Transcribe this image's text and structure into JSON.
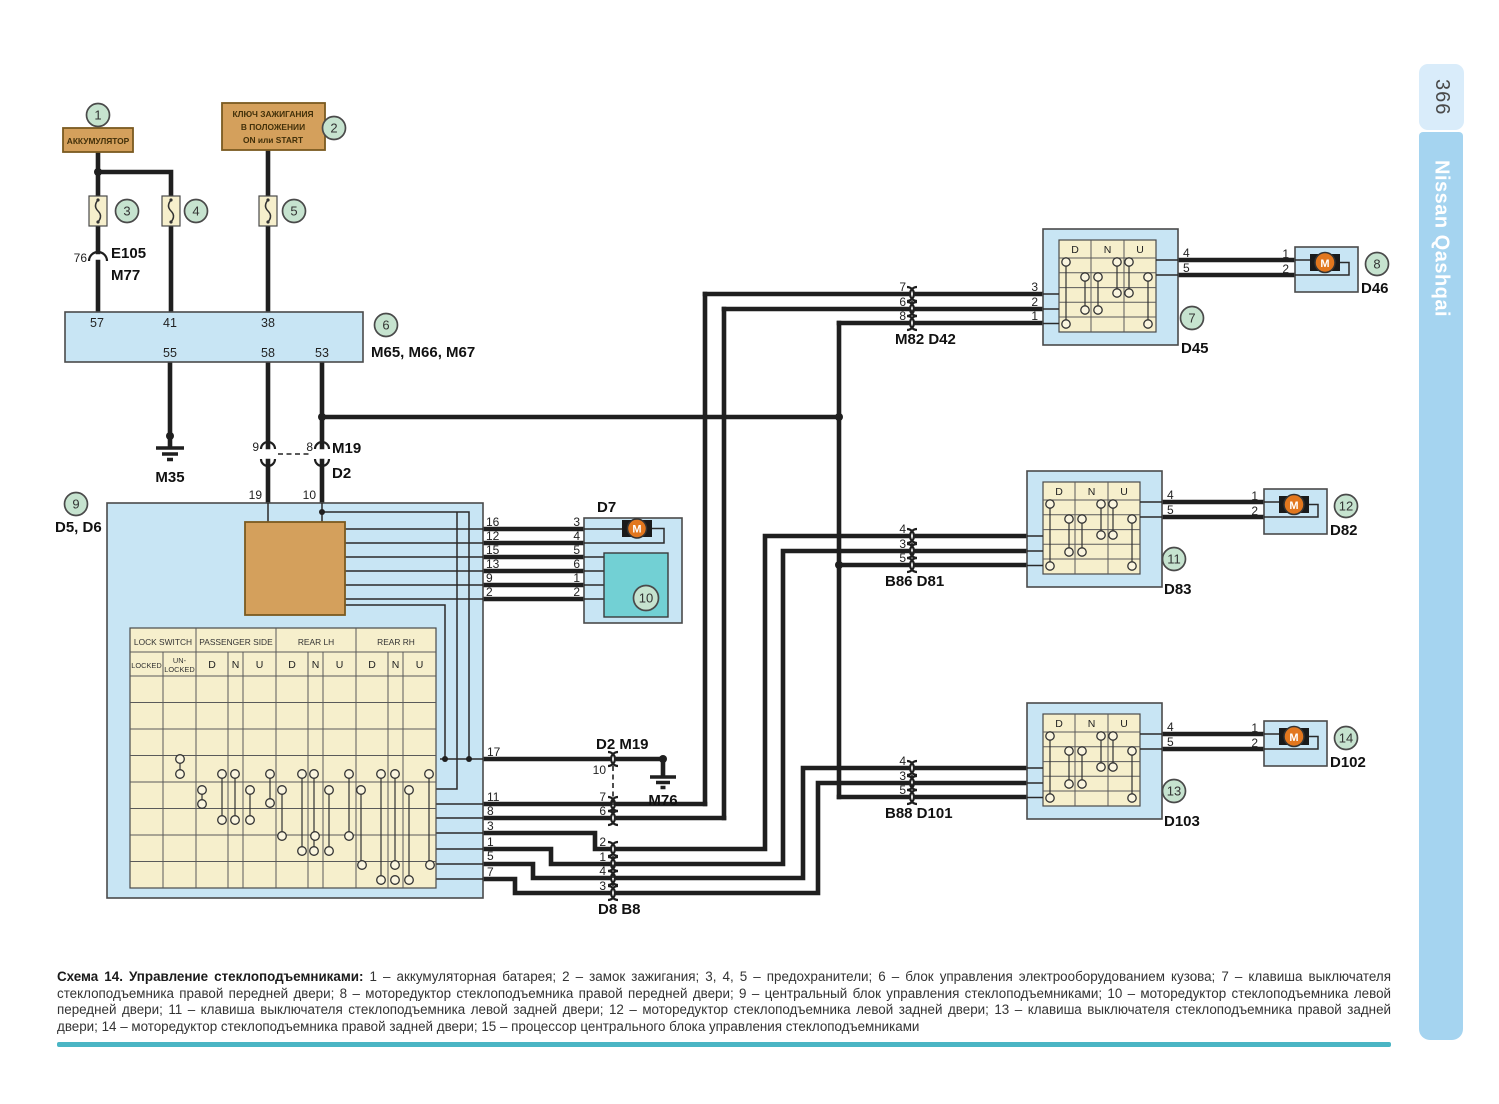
{
  "page": {
    "number": "366",
    "brand": "Nissan Qashqai"
  },
  "caption": {
    "title": "Схема 14. Управление стеклоподъемниками:",
    "body": "1 – аккумуляторная батарея; 2 – замок зажигания; 3, 4, 5 – предохранители; 6 – блок управления электрооборудованием кузова; 7 –  клавиша выключателя  стеклоподъемника правой передней двери; 8 – моторедуктор стеклоподъемника правой передней двери; 9 – центральный блок управления стеклоподъемниками; 10 – моторедуктор стеклоподъемника левой передней двери; 11 –  клавиша выключателя  стеклоподъемника левой задней двери; 12 – моторедуктор стеклоподъемника левой задней двери; 13 – клавиша выключателя  стеклоподъемника правой задней двери; 14 – моторедуктор стеклоподъемника правой задней двери; 15 – процессор центрального блока управления стеклоподъемниками"
  },
  "labels": {
    "battery": "АККУМУЛЯТОР",
    "ignition1": "КЛЮЧ ЗАЖИГАНИЯ",
    "ignition2": "В ПОЛОЖЕНИИ",
    "ignition3": "ON или START",
    "e105_pin": "76",
    "e105": "E105",
    "m77": "M77",
    "bcm_name": "M65, M66, M67",
    "m35": "M35",
    "m76": "M76",
    "m19": "M19",
    "d2": "D2",
    "d5d6": "D5, D6",
    "d7": "D7",
    "conn_d2m19": "D2  M19",
    "conn_d8b8": "D8  B8",
    "conn_m82": "M82  D42",
    "conn_b86": "B86  D81",
    "conn_b88": "B88  D101",
    "d45": "D45",
    "d46": "D46",
    "d83": "D83",
    "d82": "D82",
    "d103": "D103",
    "d102": "D102",
    "motor": "M"
  },
  "circles": {
    "c1": "1",
    "c2": "2",
    "c3": "3",
    "c4": "4",
    "c5": "5",
    "c6": "6",
    "c7": "7",
    "c8": "8",
    "c9": "9",
    "c10": "10",
    "c11": "11",
    "c12": "12",
    "c13": "13",
    "c14": "14"
  },
  "dnu": [
    "D",
    "N",
    "U"
  ],
  "table": {
    "groups": [
      "LOCK SWITCH",
      "PASSENGER SIDE",
      "REAR LH",
      "REAR RH"
    ],
    "locked": "LOCKED",
    "unlocked_1": "UN-",
    "unlocked_2": "LOCKED"
  },
  "pins": {
    "bcm_top": [
      "57",
      "41",
      "38"
    ],
    "bcm_bottom": [
      "55",
      "58",
      "53"
    ],
    "m19_top": [
      "9",
      "8"
    ],
    "block9_top": [
      "19",
      "10"
    ],
    "d7_left": [
      "16",
      "12",
      "15",
      "13",
      "9",
      "2"
    ],
    "d7_right": [
      "3",
      "4",
      "5",
      "6",
      "1",
      "2"
    ],
    "block9_right": [
      "17",
      "11",
      "8",
      "3",
      "1",
      "5",
      "7"
    ],
    "d2m19": [
      "10",
      "7",
      "6"
    ],
    "d8b8": [
      "2",
      "1",
      "4",
      "3"
    ],
    "m82_left": [
      "7",
      "6",
      "8"
    ],
    "m82_right": [
      "3",
      "2",
      "1"
    ],
    "b86_left": [
      "4",
      "3",
      "5"
    ],
    "b86_right": [
      "3",
      "2",
      "1"
    ],
    "b88_left": [
      "4",
      "3",
      "5"
    ],
    "b88_right": [
      "3",
      "2",
      "1"
    ],
    "sw_out": [
      "4",
      "5"
    ],
    "motor_in": [
      "1",
      "2"
    ]
  },
  "colors": {
    "wire": "#1f1f1f",
    "block_blue": "#c8e5f4",
    "cream": "#f6efcc",
    "tan": "#d4a05c",
    "teal": "#72d0d4",
    "green_badge": "#c6e3cf",
    "motor_orange": "#e2771e",
    "sidebar_tab": "#d9ecfa",
    "sidebar_bar": "#a5d4f0",
    "rule_teal": "#4ab5c4"
  }
}
